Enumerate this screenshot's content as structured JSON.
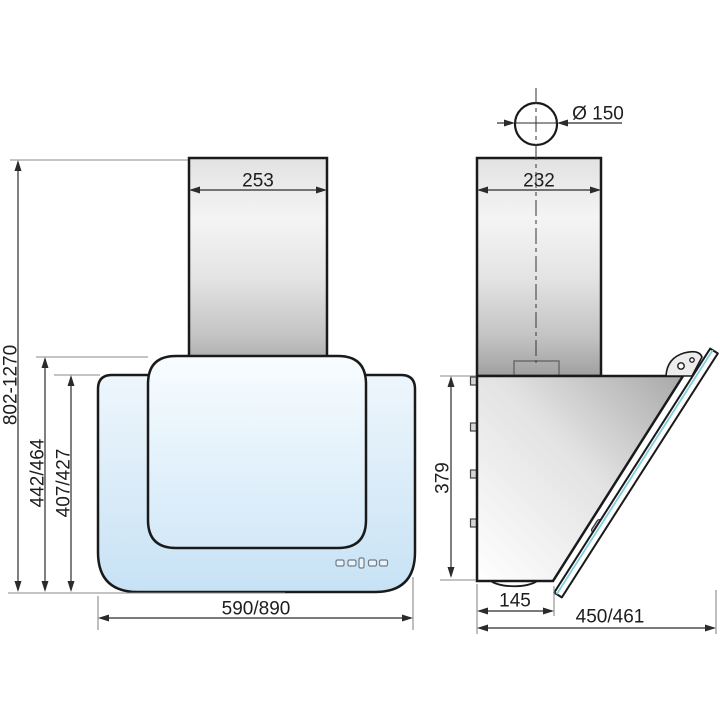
{
  "front_view": {
    "chimney_width_mm": "253",
    "height_range_mm": "802-1270",
    "glass_height_mm": "442/464",
    "body_height_mm": "407/427",
    "width_mm": "590/890",
    "touch_keys": [
      "touch-key-1",
      "touch-key-2",
      "touch-key-3",
      "touch-key-4",
      "touch-key-5"
    ]
  },
  "side_view": {
    "duct_diameter_mm": "Ø 150",
    "chimney_depth_mm": "232",
    "body_height_mm": "379",
    "base_depth_mm": "145",
    "total_depth_mm": "450/461"
  },
  "colors": {
    "outline": "#1a1a1a",
    "dimension_line": "#2b2b2b",
    "extension_line": "#8a8a8a",
    "glass_blue_top": "#f6fafd",
    "glass_blue_bottom": "#c7e2f5",
    "steel_light": "#f3f3f3",
    "steel_dark": "#a2a2a2",
    "glass_edge_accent": "#7fd0df"
  }
}
